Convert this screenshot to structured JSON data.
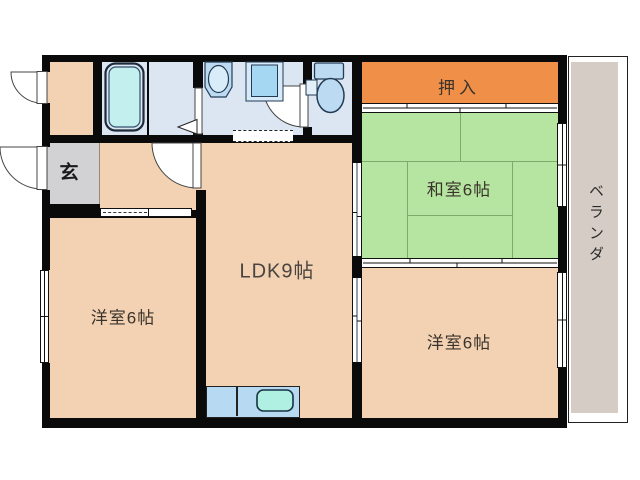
{
  "rooms": {
    "oshiire": {
      "label": "押入",
      "color": "#f09048"
    },
    "washitsu": {
      "label": "和室6帖",
      "color": "#b5e5a0"
    },
    "ldk": {
      "label": "LDK9帖",
      "color": "#f2d2b2"
    },
    "youshitsu_left": {
      "label": "洋室6帖",
      "color": "#f2d2b2"
    },
    "youshitsu_right": {
      "label": "洋室6帖",
      "color": "#f2d2b2"
    },
    "genkan": {
      "label": "玄",
      "color": "#d2d2d4"
    },
    "veranda": {
      "label": "ベランダ",
      "color": "#d5ccc5"
    },
    "bathroom": {
      "color": "#dbe6f2"
    },
    "washroom": {
      "color": "#dbe6f2"
    },
    "toilet_room": {
      "color": "#dbe6f2"
    }
  },
  "fixtures": [
    "bathtub",
    "wash-basin",
    "washing-machine-pan",
    "toilet",
    "kitchen-counter",
    "kitchen-sink"
  ],
  "colors": {
    "wall": "#0a0a0a",
    "tatami_line": "#7cab6b",
    "fixture_fill": "#bcdaf2",
    "bathtub_fill": "#c3efef",
    "kitchen_sink_fill": "#aff0e2",
    "label_text": "#3b332c"
  }
}
